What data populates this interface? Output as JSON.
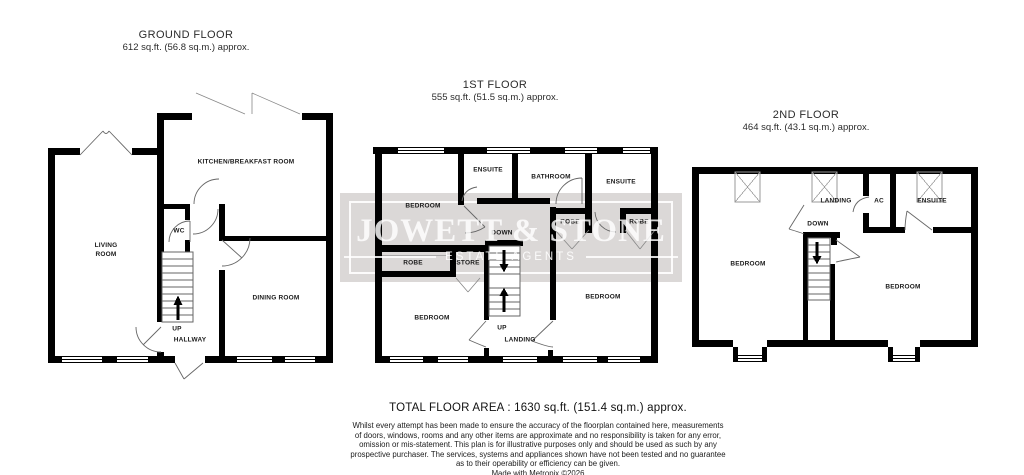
{
  "watermark": {
    "name": "JOWETT & STONE",
    "tagline": "ESTATE AGENTS"
  },
  "colors": {
    "wall": "#000000",
    "watermark_band": "#dbd8d7",
    "watermark_text": "#ffffff",
    "thin_line": "#666666"
  },
  "floors": {
    "ground": {
      "title": "GROUND FLOOR",
      "area": "612 sq.ft. (56.8 sq.m.) approx.",
      "rooms": {
        "living": "LIVING ROOM",
        "wc": "WC",
        "kitchen": "KITCHEN/BREAKFAST ROOM",
        "dining": "DINING ROOM",
        "hallway": "HALLWAY"
      },
      "stairs": {
        "up": "UP"
      }
    },
    "first": {
      "title": "1ST FLOOR",
      "area": "555 sq.ft. (51.5 sq.m.) approx.",
      "rooms": {
        "bedroom_top": "BEDROOM",
        "ensuite_left": "ENSUITE",
        "bathroom": "BATHROOM",
        "ensuite_right": "ENSUITE",
        "robe_mid": "ROBE",
        "robe_right": "ROBE",
        "robe_left": "ROBE",
        "store": "STORE",
        "bedroom_left": "BEDROOM",
        "bedroom_right": "BEDROOM",
        "landing": "LANDING"
      },
      "stairs": {
        "up": "UP",
        "down": "DOWN"
      }
    },
    "second": {
      "title": "2ND FLOOR",
      "area": "464 sq.ft. (43.1 sq.m.) approx.",
      "rooms": {
        "landing": "LANDING",
        "ac": "AC",
        "ensuite": "ENSUITE",
        "bedroom_left": "BEDROOM",
        "bedroom_right": "BEDROOM"
      },
      "stairs": {
        "down": "DOWN"
      }
    }
  },
  "footer": {
    "total_area": "TOTAL FLOOR AREA : 1630 sq.ft. (151.4 sq.m.) approx.",
    "disclaimer_lines": [
      "Whilst every attempt has been made to ensure the accuracy of the floorplan contained here, measurements",
      "of doors, windows, rooms and any other items are approximate and no responsibility is taken for any error,",
      "omission or mis-statement. This plan is for illustrative purposes only and should be used as such by any",
      "prospective purchaser. The services, systems and appliances shown have not been tested and no guarantee",
      "as to their operability or efficiency can be given."
    ],
    "credit": "Made with Metropix ©2026"
  }
}
